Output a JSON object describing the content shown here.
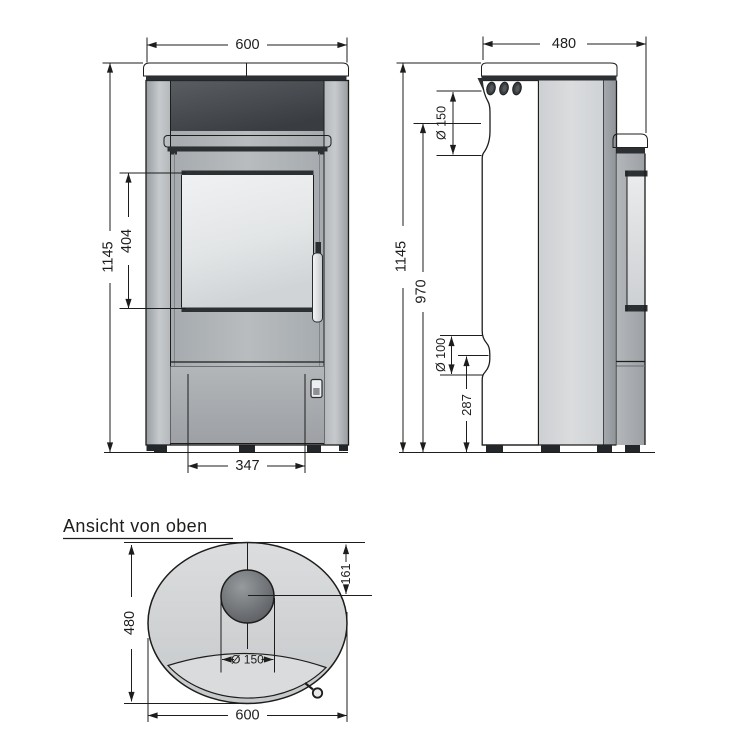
{
  "views": {
    "front": {
      "width": "600",
      "height": "1145",
      "glass_height": "404",
      "door_width": "347"
    },
    "side": {
      "depth": "480",
      "height": "1145",
      "flue_center_height": "970",
      "flue_diameter": "Ø 150",
      "outlet_diameter": "Ø 100",
      "outlet_center_height": "287"
    },
    "top": {
      "title": "Ansicht von oben",
      "depth": "480",
      "width": "600",
      "flue_diameter": "Ø 150",
      "flue_center_from_back": "161"
    }
  },
  "colors": {
    "line": "#1d1d1b",
    "background": "#ffffff",
    "dark_panel": "#3d4145",
    "body_gray": "#aaaeb2",
    "plate_gray": "#e3e5e7"
  }
}
